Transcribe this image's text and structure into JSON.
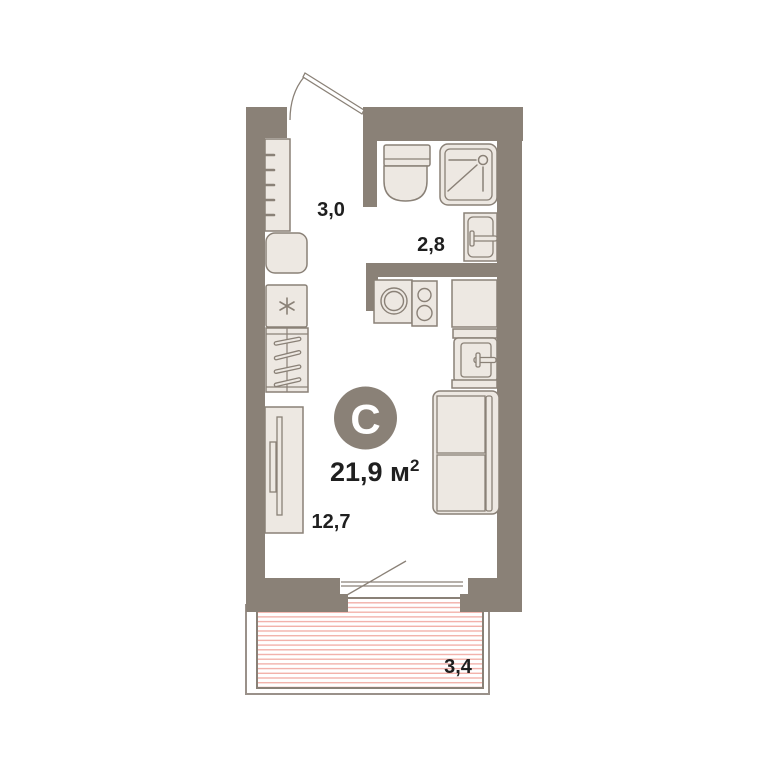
{
  "plan": {
    "badge_letter": "С",
    "total_area": {
      "label": "21,9 м",
      "superscript": "2"
    },
    "rooms": [
      {
        "id": "hallway",
        "area": "3,0"
      },
      {
        "id": "bathroom",
        "area": "2,8"
      },
      {
        "id": "living-kitchen",
        "area": "12,7"
      },
      {
        "id": "balcony",
        "area": "3,4"
      }
    ],
    "colors": {
      "wall": "#8A8177",
      "fixture_fill": "#EDE8E2",
      "fixture_stroke": "#8A8177",
      "balcony_hatch": "#F2B1AA",
      "balcony_outline": "#9A918A",
      "text": "#1F1F1F",
      "badge_fill": "#8A8177",
      "badge_text": "#FFFFFF"
    }
  }
}
